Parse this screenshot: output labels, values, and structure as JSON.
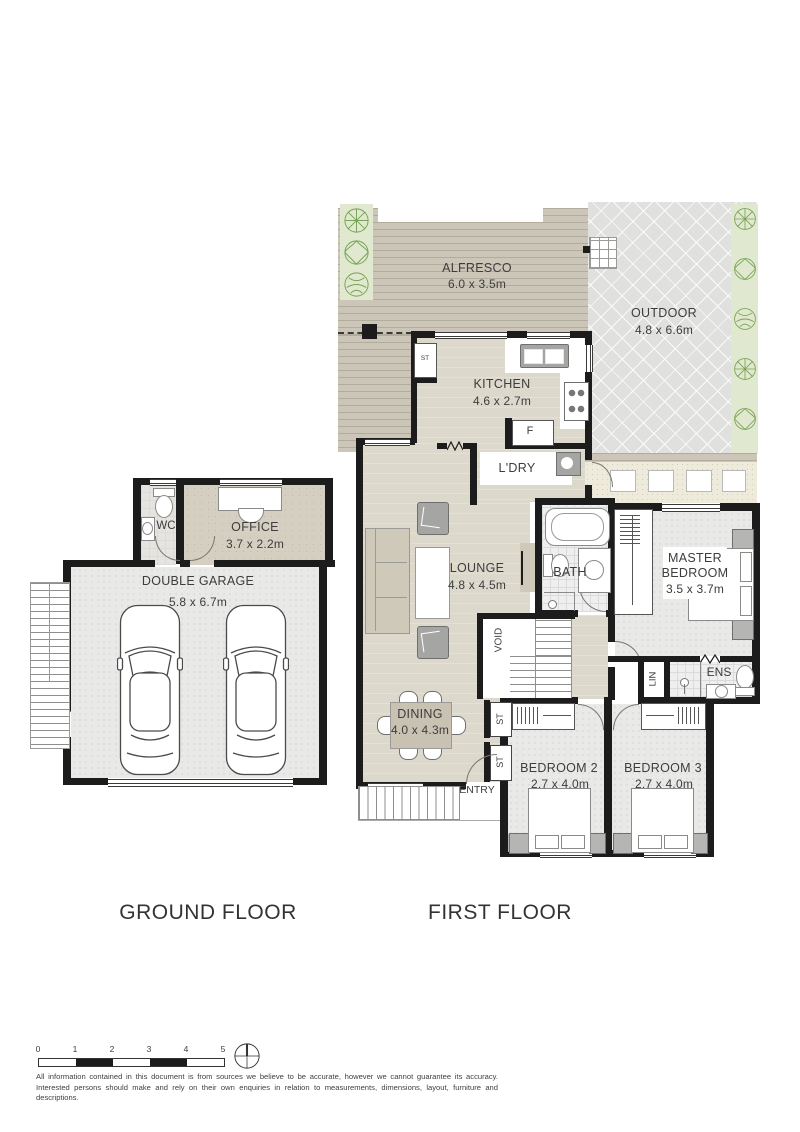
{
  "titles": {
    "ground": "GROUND FLOOR",
    "first": "FIRST FLOOR"
  },
  "rooms": {
    "alfresco": {
      "name": "ALFRESCO",
      "dims": "6.0 x 3.5m"
    },
    "outdoor": {
      "name": "OUTDOOR",
      "dims": "4.8 x 6.6m"
    },
    "kitchen": {
      "name": "KITCHEN",
      "dims": "4.6 x 2.7m"
    },
    "pantry": {
      "name": "ST"
    },
    "fridge": {
      "name": "F"
    },
    "laundry": {
      "name": "L'DRY"
    },
    "lounge": {
      "name": "LOUNGE",
      "dims": "4.8 x 4.5m"
    },
    "bath": {
      "name": "BATH"
    },
    "master": {
      "line1": "MASTER",
      "line2": "BEDROOM",
      "dims": "3.5 x 3.7m"
    },
    "void": {
      "name": "VOID"
    },
    "linen": {
      "name": "LIN"
    },
    "ensuite": {
      "name": "ENS"
    },
    "dining": {
      "name": "DINING",
      "dims": "4.0 x 4.3m"
    },
    "store_upper": {
      "name": "ST"
    },
    "store_lower": {
      "name": "ST"
    },
    "entry": {
      "name": "ENTRY"
    },
    "bedroom2": {
      "name": "BEDROOM 2",
      "dims": "2.7 x 4.0m"
    },
    "bedroom3": {
      "name": "BEDROOM 3",
      "dims": "2.7 x 4.0m"
    },
    "wc": {
      "name": "WC"
    },
    "office": {
      "name": "OFFICE",
      "dims": "3.7 x 2.2m"
    },
    "garage": {
      "name": "DOUBLE GARAGE",
      "dims": "5.8 x 6.7m"
    }
  },
  "scale_bar": {
    "ticks": [
      "0",
      "1",
      "2",
      "3",
      "4",
      "5"
    ]
  },
  "disclaimer": "All information contained in this document is from sources we believe to be accurate, however we cannot guarantee its accuracy. Interested persons should make and rely on their own enquiries in relation to measurements, dimensions, layout, furniture and descriptions.",
  "colors": {
    "wall": "#1c1c1c",
    "deck": "#ccc6b8",
    "outdoor_paving": "#e0e1de",
    "garden": "#e0e9cf",
    "plant": "#79a256",
    "interior_floor": "#dcd8cb",
    "office_floor": "#d5cfc1",
    "carpet": "#e9eae8",
    "path": "#eeebdc",
    "fixture_gray": "#9a9a98"
  }
}
